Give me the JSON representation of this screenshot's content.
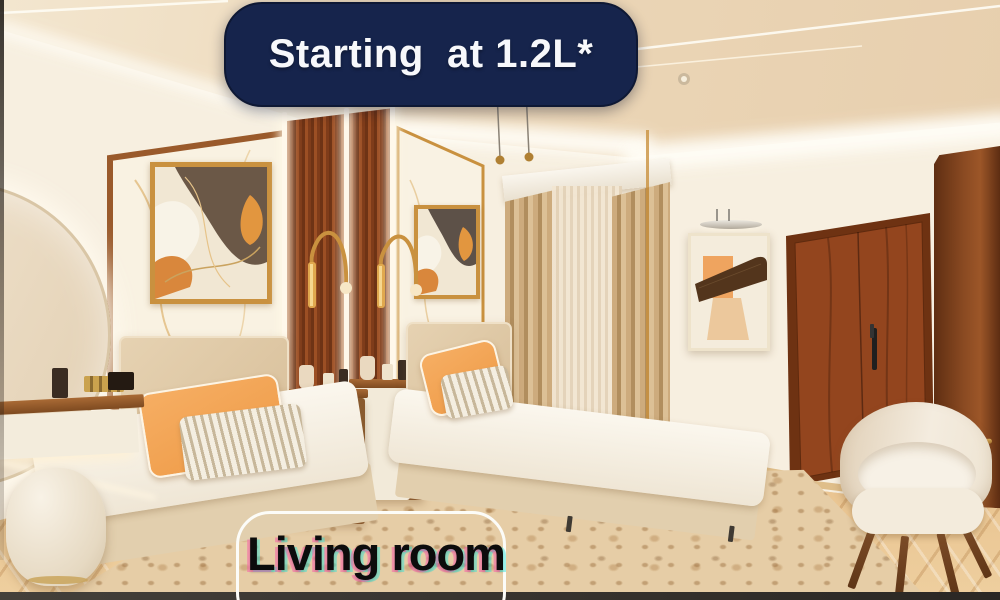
{
  "overlay": {
    "price_banner": {
      "text": "Starting  at 1.2L*",
      "bg_color": "#16244c",
      "text_color": "#f7f8fb"
    },
    "room_label": {
      "text": "Living room",
      "text_color": "#0c0c0c",
      "border_color": "#fcfcf8"
    }
  },
  "palette": {
    "wall": "#f7efe0",
    "ceiling": "#ecd7b8",
    "wood_trim": "#9a5a2b",
    "slat_wood": "#8a4520",
    "brass": "#c9913f",
    "door_wood": "#93451e",
    "floor": "#eac592",
    "rug": "#e6cda6",
    "pillow_orange": "#f3a45f",
    "headboard": "#dcc3a0",
    "bedding": "#f8f3ea",
    "curtain": "#c2a074",
    "banner_navy": "#16244c",
    "bottom_bar": "#332f2a"
  }
}
